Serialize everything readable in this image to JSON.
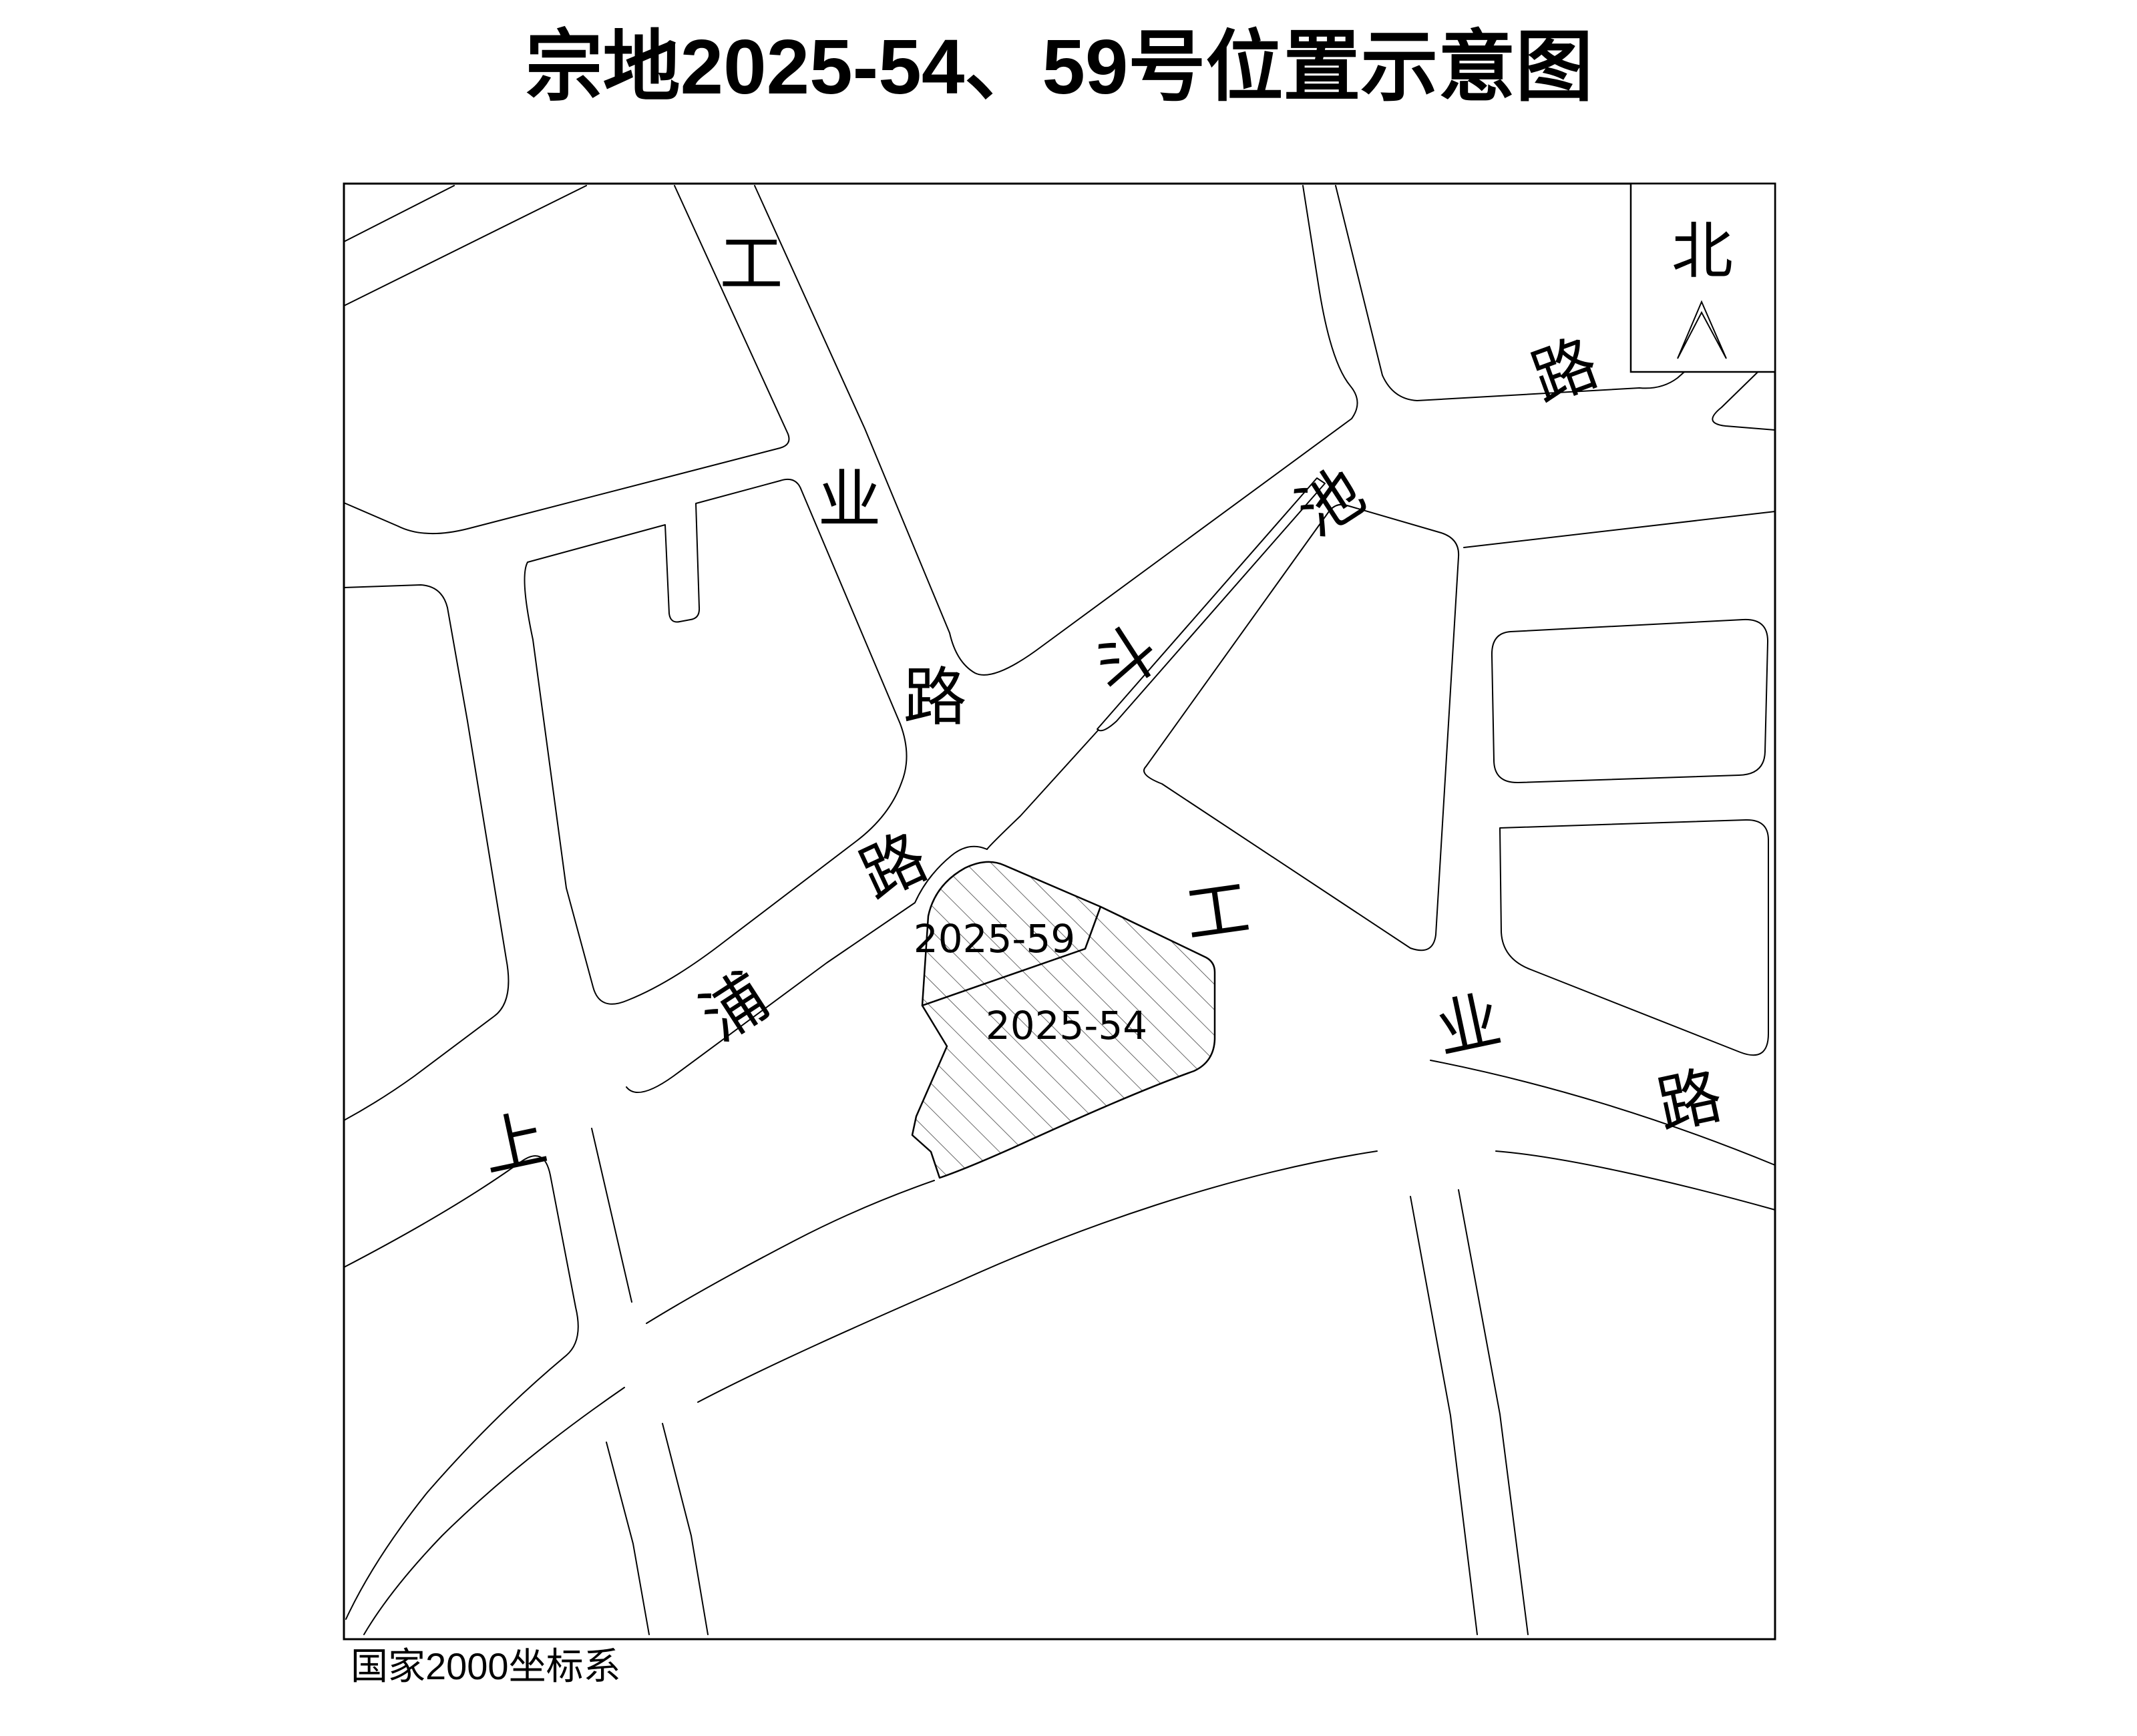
{
  "title": "宗地2025-54、59号位置示意图",
  "map": {
    "footer": "国家2000坐标系",
    "north_label": "北",
    "parcels": [
      {
        "id": "2025-59"
      },
      {
        "id": "2025-54"
      }
    ],
    "roads": [
      {
        "name": "工业路(北段)",
        "chars": [
          "工",
          "业",
          "路"
        ]
      },
      {
        "name": "斗池路",
        "chars": [
          "斗",
          "池",
          "路"
        ]
      },
      {
        "name": "上浦路",
        "chars": [
          "上",
          "浦",
          "路"
        ]
      },
      {
        "name": "工业路(东段)",
        "chars": [
          "工",
          "业",
          "路"
        ]
      }
    ],
    "colors": {
      "background": "#ffffff",
      "line": "#000000",
      "hatch": "#444444"
    }
  }
}
